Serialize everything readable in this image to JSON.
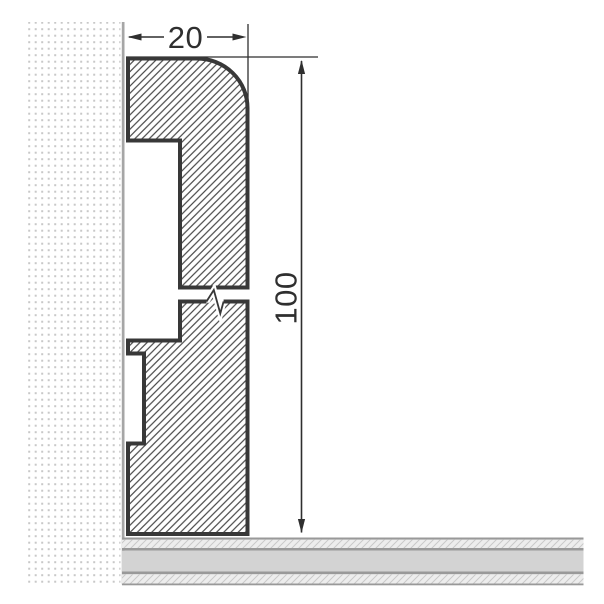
{
  "drawing": {
    "dimensions": {
      "width_label": "20",
      "height_label": "100"
    },
    "colors": {
      "background": "#ffffff",
      "outline": "#383838",
      "hatch_line": "#4a4a4a",
      "dimension": "#2f2f2f",
      "wall_dot": "#c8c8c8",
      "wall_edge": "#a6a6a6",
      "floor_line": "#999999",
      "floor_solid": "#d3d3d3",
      "floor_hatch_bg": "#ededed",
      "floor_hatch_line": "#c9c9c9"
    }
  }
}
